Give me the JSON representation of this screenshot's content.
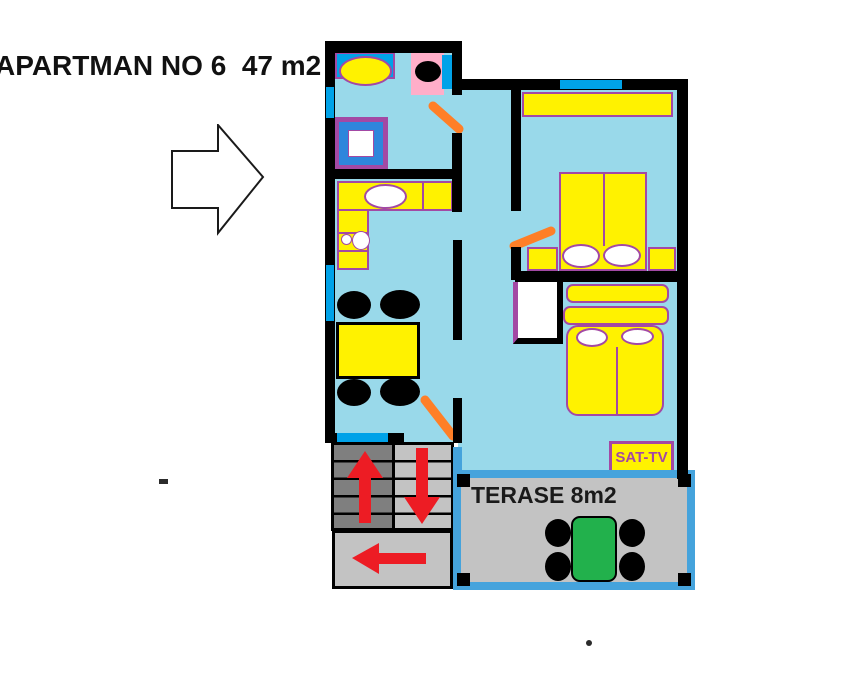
{
  "title": "APARTMAN NO 6  47 m2",
  "plan": {
    "terrace_label": "TERASE 8m2",
    "sat_tv_label": "SAT-TV"
  },
  "colors": {
    "floor": "#99D9EA",
    "wall": "#000000",
    "yellow": "#FFF200",
    "purple": "#A349A4",
    "blue": "#00A2E8",
    "shower-blue": "#2E86DC",
    "pink": "#FFAEC9",
    "orange": "#FF7F27",
    "red": "#ED1C24",
    "stair-dark": "#7F7F7F",
    "stair-light": "#C3C3C3",
    "terrace-border": "#45A3DC",
    "green": "#22B14C",
    "text": "#111111"
  },
  "icons": {
    "direction-arrow": "hollow right-pointing arrow",
    "stairs-up-arrow": "red arrow up",
    "stairs-down-arrow": "red arrow down",
    "stairs-exit-arrow": "red arrow left",
    "door-swing": "orange diagonal door-swing stroke"
  }
}
